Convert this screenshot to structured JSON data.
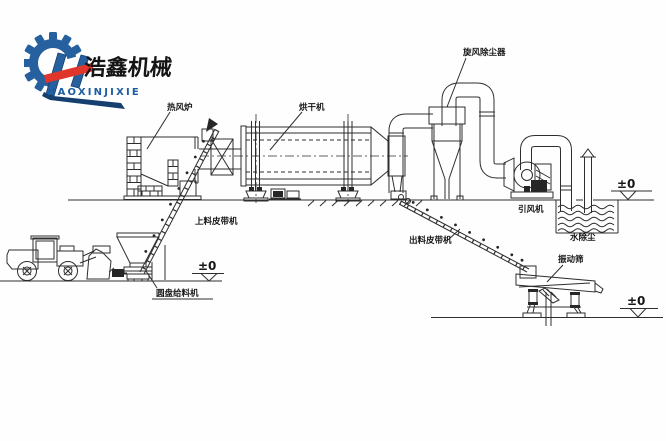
{
  "logo": {
    "company_name_cn": "浩鑫机械",
    "company_name_en": "HAOXINJIXIE",
    "colors": {
      "gear_blue": "#27609f",
      "navy": "#153f6e",
      "red": "#df352a",
      "english_blue": "#1d5ca3",
      "chinese_black": "#141414"
    }
  },
  "diagram": {
    "line_color": "#2d2d2d",
    "labels": {
      "hot_air_furnace": "热风炉",
      "dryer": "烘干机",
      "cyclone_dust_collector": "旋风除尘器",
      "feed_belt_conveyor": "上料皮带机",
      "discharge_belt_conveyor": "出料皮带机",
      "induced_draft_fan": "引风机",
      "water_dust_collector": "水除尘",
      "vibrating_screen": "振动筛",
      "disc_feeder": "圆盘给料机",
      "elevation_marker": "±0"
    }
  }
}
